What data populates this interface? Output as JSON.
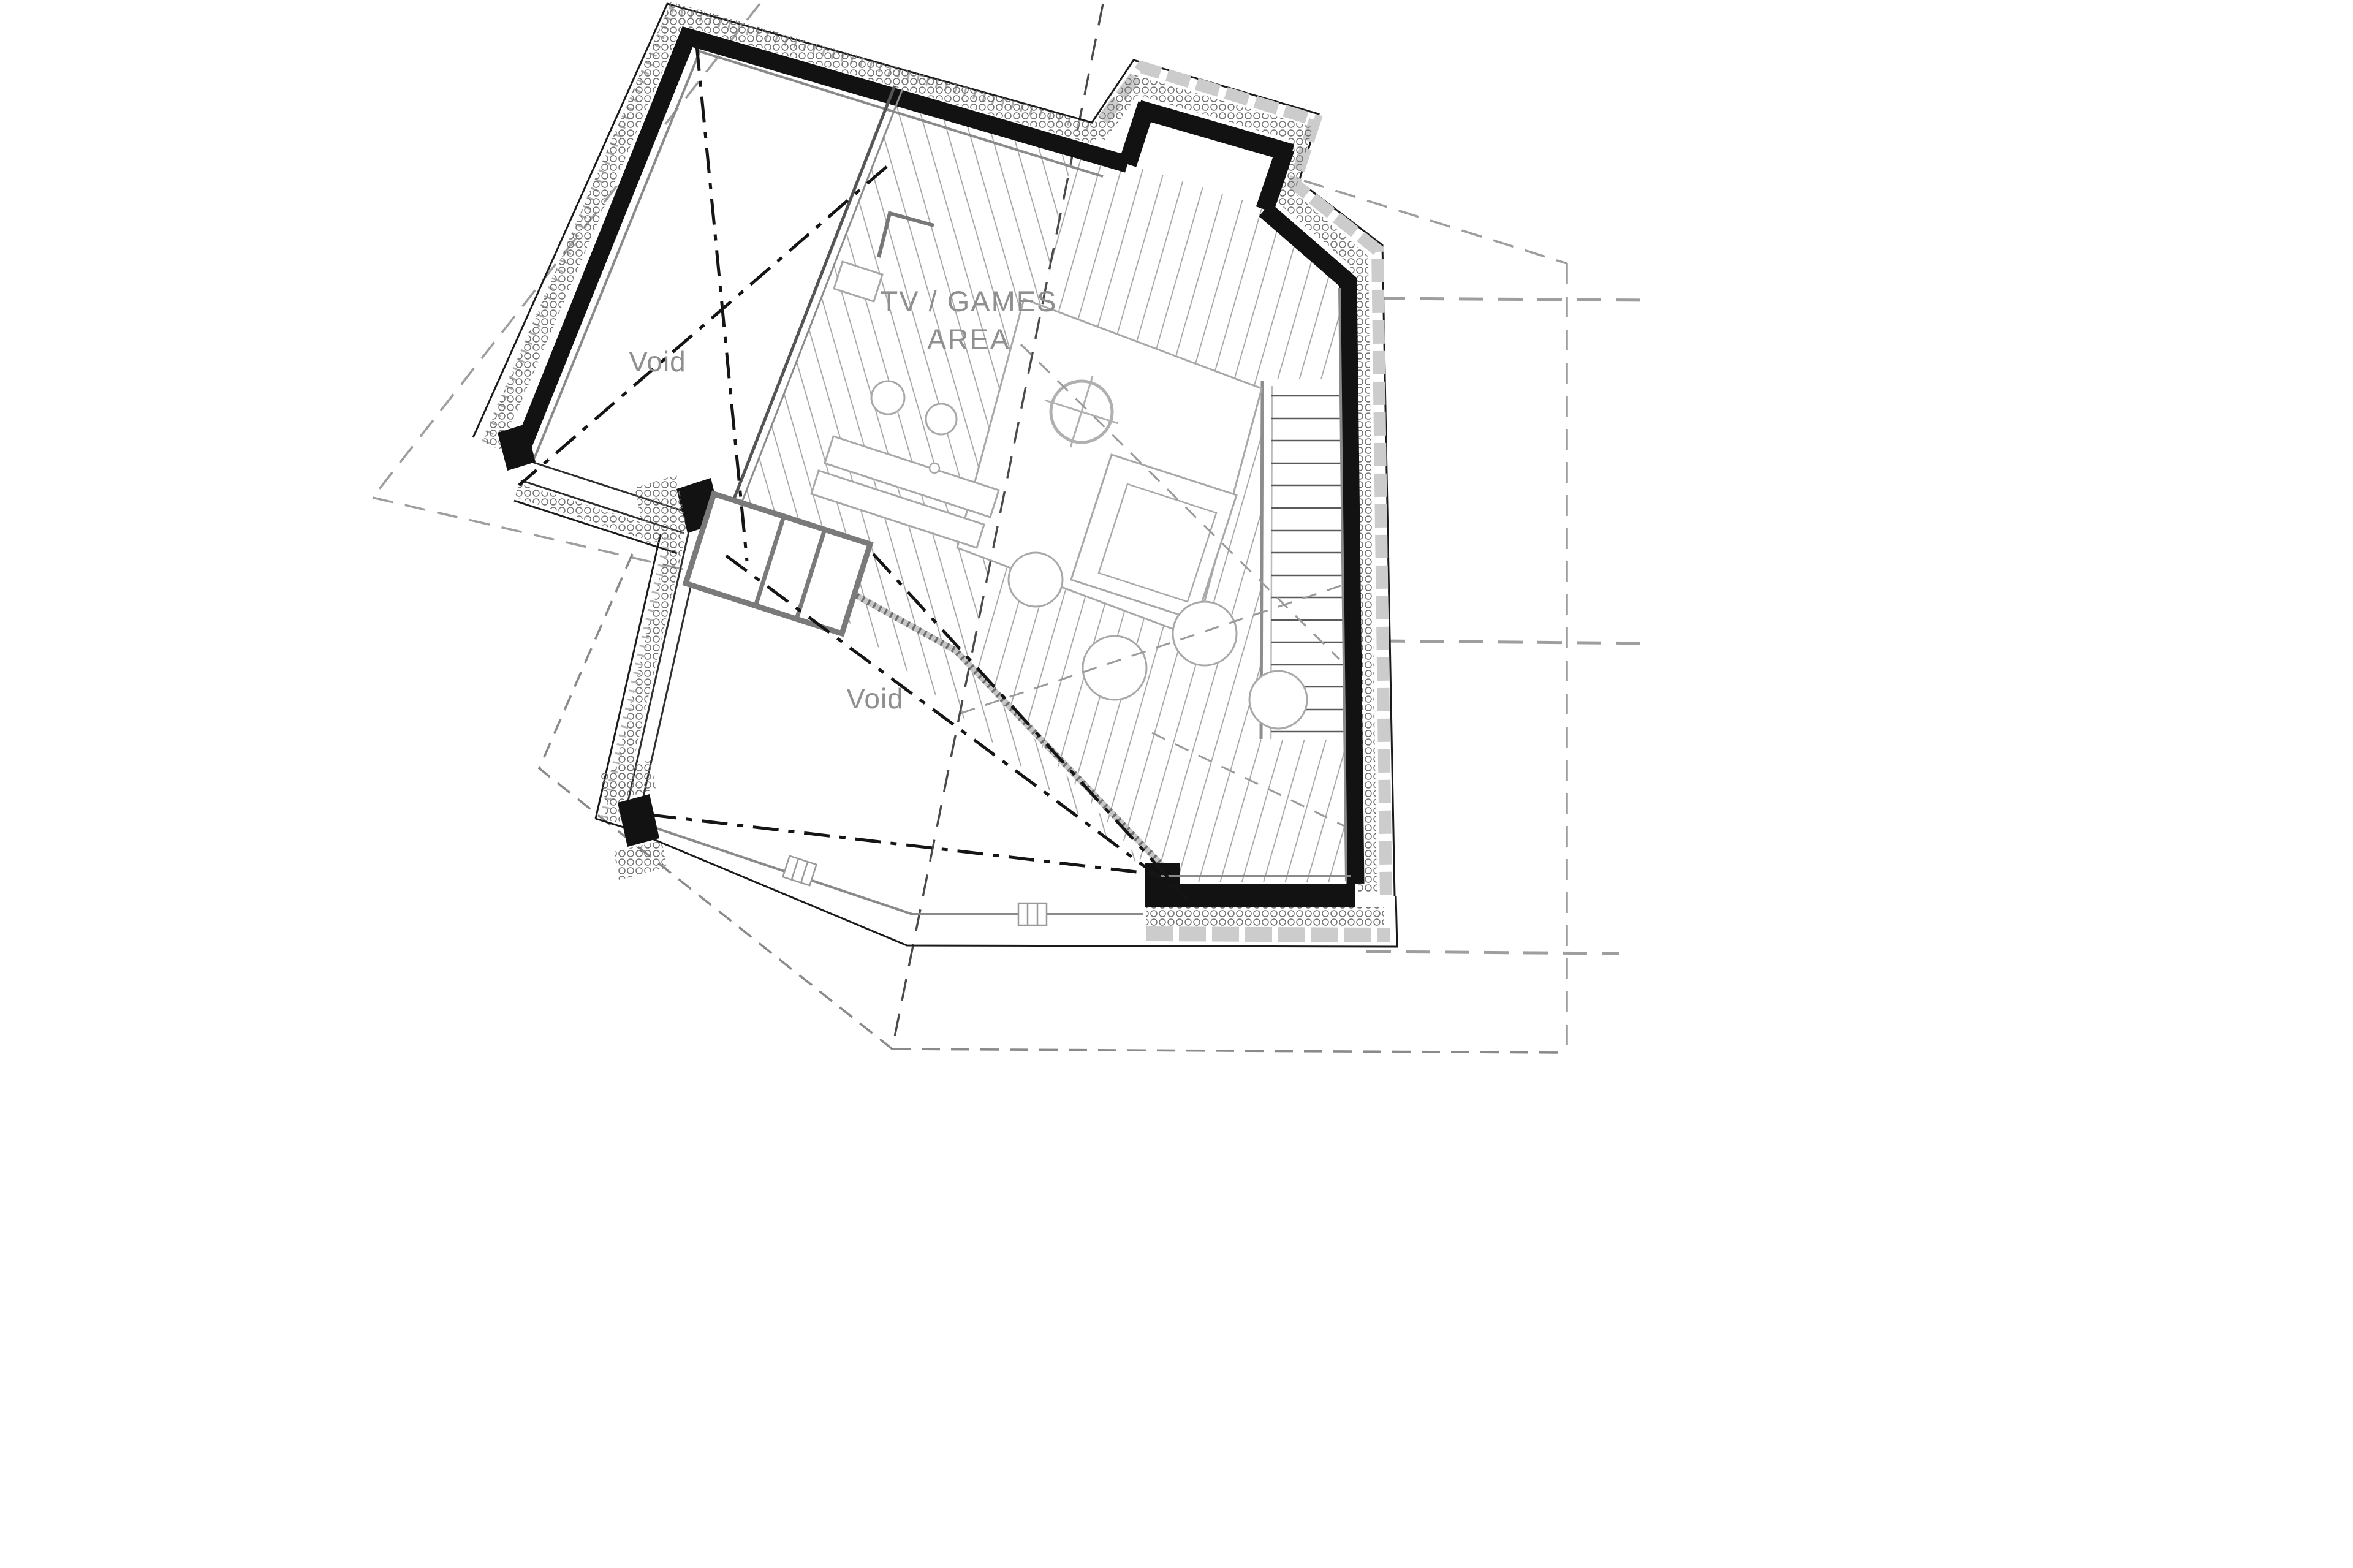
{
  "labels": {
    "room_area_line1": "TV / GAMES",
    "room_area_line2": "AREA",
    "void_upper": "Void",
    "void_lower": "Void"
  },
  "colors": {
    "background": "#ffffff",
    "wall_fill": "#121212",
    "label_gray": "#8f8f8f",
    "floor_line_gray": "#a3a3a3",
    "dash_gray": "#9e9e9e",
    "detail_gray": "#777777"
  }
}
